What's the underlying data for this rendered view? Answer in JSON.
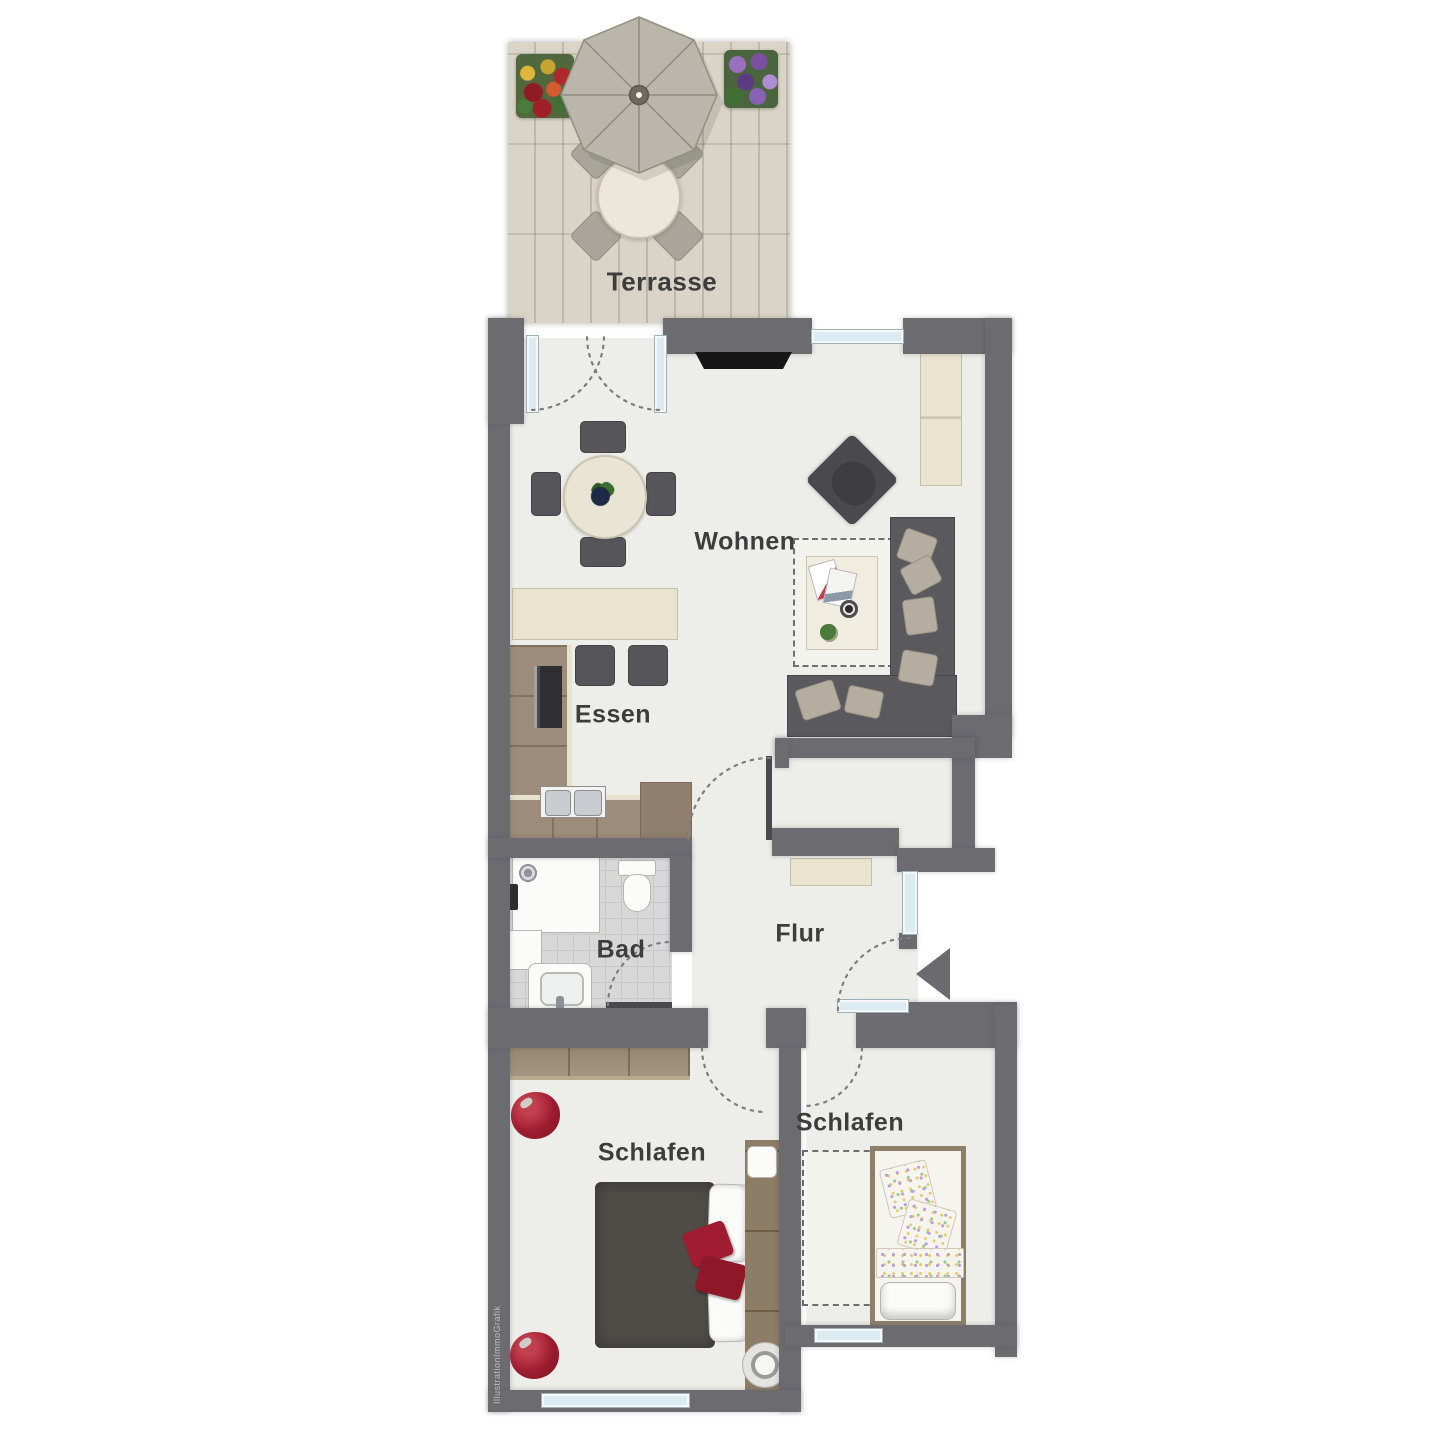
{
  "labels": {
    "terrasse": "Terrasse",
    "wohnen": "Wohnen",
    "essen": "Essen",
    "bad": "Bad",
    "flur": "Flur",
    "schlafen_main": "Schlafen",
    "schlafen_second": "Schlafen"
  },
  "watermark": "IllustrationImmoGrafik",
  "colors": {
    "wall": "#6b6b70",
    "floor": "#edeee9",
    "bath_tile": "#d8d8d8",
    "terrace_deck": "#d9d4c7",
    "kitchen_wood": "#9c8c79",
    "wardrobe_wood": "#97876f",
    "headboard_wood": "#8d7c66",
    "cream_counter": "#e9e3d0",
    "dark_furniture": "#56555a",
    "sofa": "#5a595d",
    "cushion": "#b5ada0",
    "accent_red": "#9d1c30",
    "window_glazing": "#dcebf2",
    "label_text": "#3d3d3d",
    "bed_blanket": "#4f4b47"
  },
  "icons": {
    "entrance_arrow": "triangle-pointing-left",
    "parasol": "octagonal-umbrella"
  }
}
